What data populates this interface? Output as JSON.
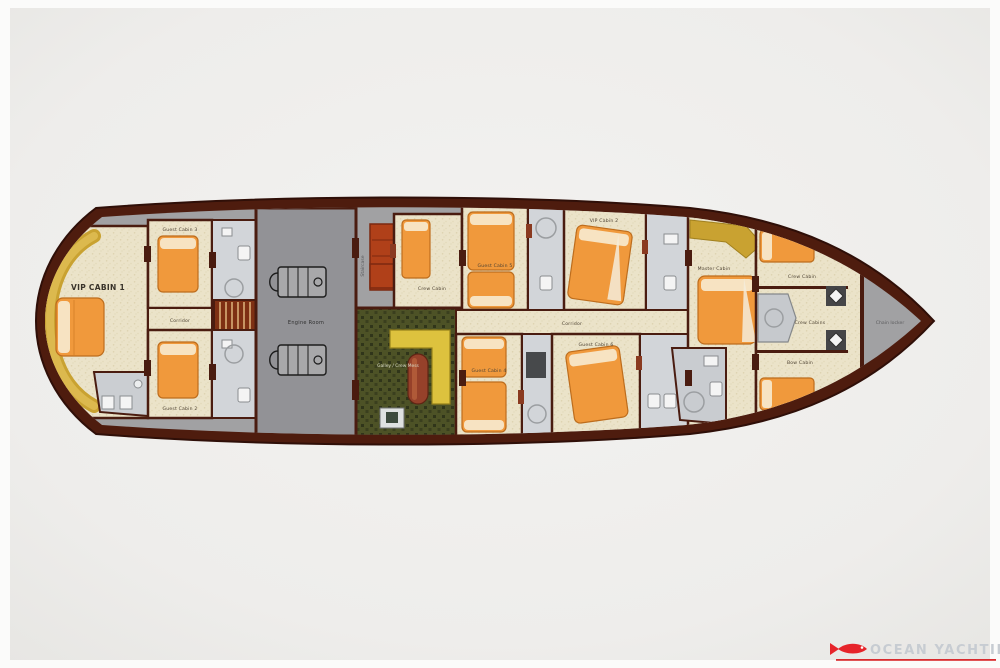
{
  "plan": {
    "type": "yacht-lower-deck-floor-plan",
    "rooms": {
      "vip1": "VIP CABIN 1",
      "guest3": "Guest Cabin 3",
      "guest2": "Guest Cabin 2",
      "corridor_aft": "Corridor",
      "engine": "Engine Room",
      "staircase": "Staircase",
      "crew_mid": "Crew Cabin",
      "galley": "Galley / Crew Mess",
      "guest5": "Guest Cabin 5",
      "vip2": "VIP Cabin 2",
      "corridor_fwd": "Corridor",
      "guest4": "Guest Cabin 4",
      "guest6": "Guest Cabin 6",
      "master": "Master Cabin",
      "crew_fwd1": "Crew Cabin",
      "crew_fwd2": "Crew Cabins",
      "bow_cabin": "Bow Cabin",
      "chain_locker": "Chain locker"
    }
  },
  "watermark": {
    "brand": "OCEAN YACHTING"
  },
  "icons": {
    "watermark_logo": "fish-icon"
  },
  "colors": {
    "hull": "#4e1c0e",
    "deck": "#a1a1a3",
    "cabin_floor": "#ebe3c9",
    "bathroom": "#d2d5d9",
    "bed_orange": "#f0993c",
    "sofa_yellow": "#c9a231",
    "galley_green": "#4d5226",
    "counter_yellow": "#ddc23e",
    "engine_room_gray": "#929296",
    "crew_bunk_red": "#b04019",
    "watermark_red": "#e6242a",
    "watermark_gray": "#c7ccd2"
  }
}
